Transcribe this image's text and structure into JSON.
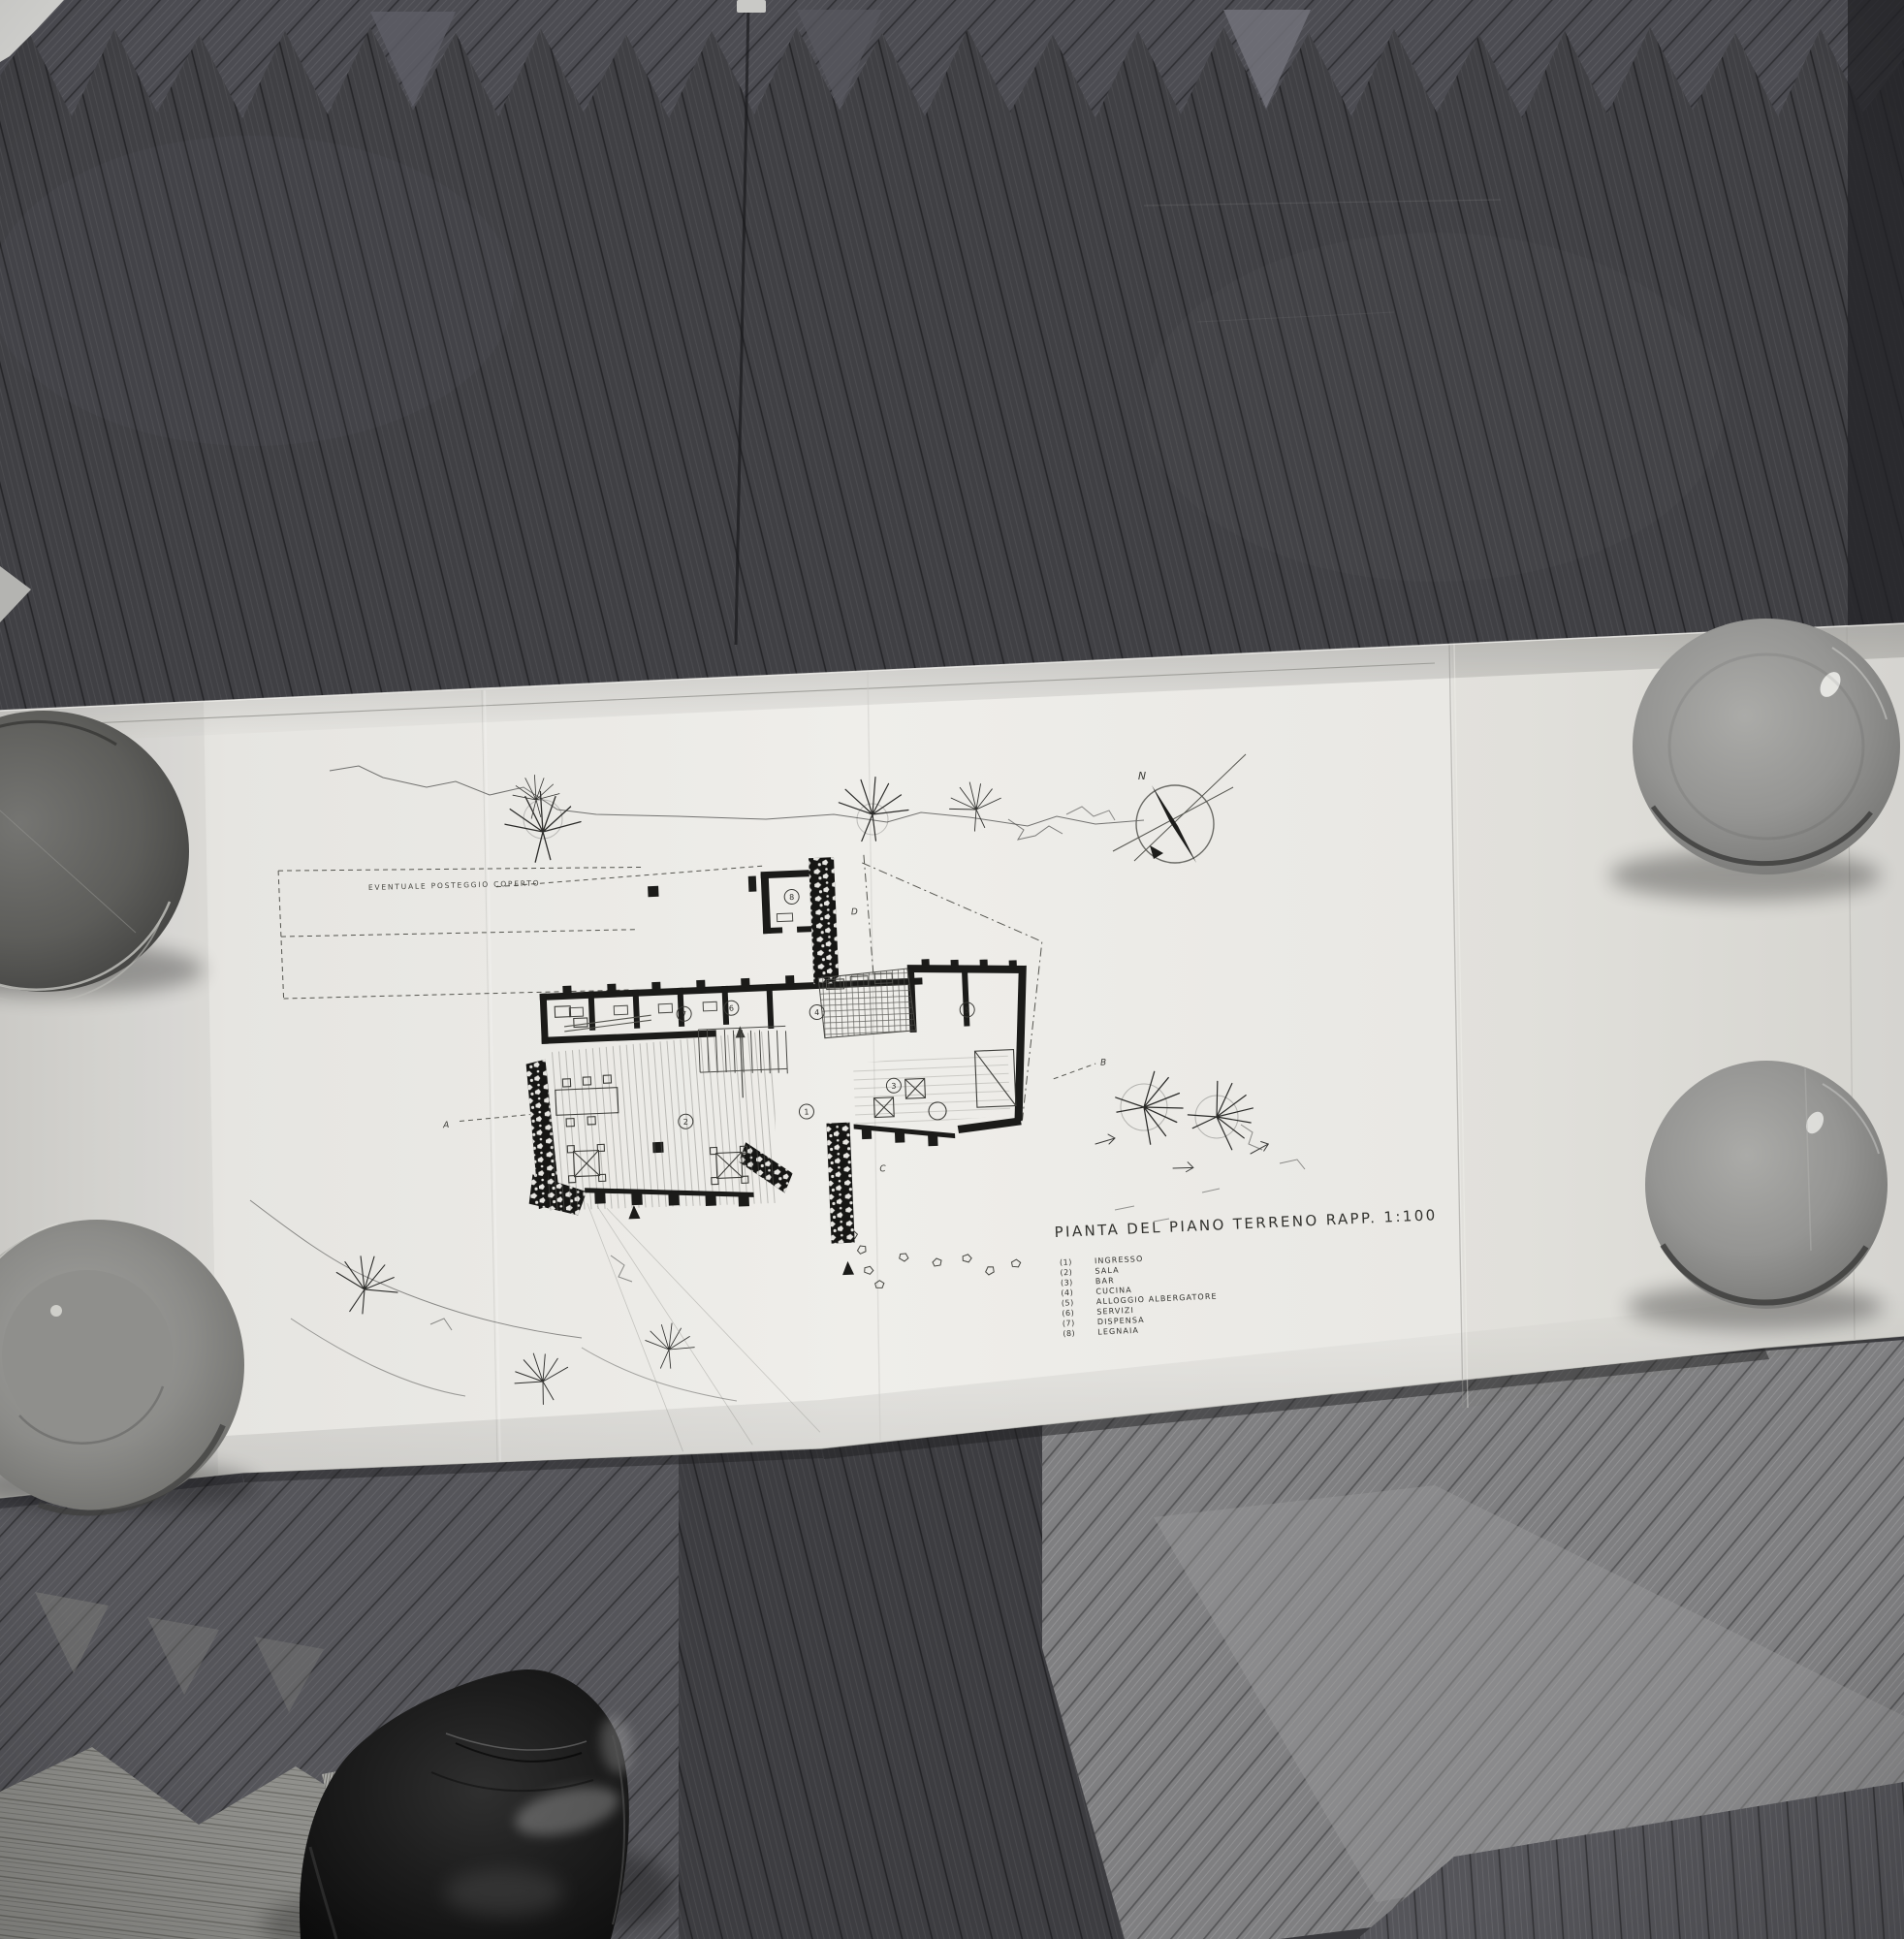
{
  "drawing": {
    "title": "PIANTA DEL PIANO TERRENO  RAPP. 1:100",
    "site_note": "EVENTUALE  POSTEGGIO  COPERTO",
    "compass_label": "N",
    "section_markers": [
      "A",
      "B",
      "C",
      "D"
    ],
    "room_numbers": [
      "1",
      "2",
      "3",
      "4",
      "5",
      "6",
      "7",
      "8"
    ],
    "legend": [
      {
        "num": "(1)",
        "label": "INGRESSO"
      },
      {
        "num": "(2)",
        "label": "SALA"
      },
      {
        "num": "(3)",
        "label": "BAR"
      },
      {
        "num": "(4)",
        "label": "CUCINA"
      },
      {
        "num": "(5)",
        "label": "ALLOGGIO ALBERGATORE"
      },
      {
        "num": "(6)",
        "label": "SERVIZI"
      },
      {
        "num": "(7)",
        "label": "DISPENSA"
      },
      {
        "num": "(8)",
        "label": "LEGNAIA"
      }
    ]
  },
  "palette": {
    "paper": "#efeeea",
    "floor_dark": "#404044",
    "floor_mid": "#55555a",
    "floor_light": "#7f7f81",
    "ink": "#2a2a28",
    "bowl_gray": "#949492",
    "shoe_black": "#141414"
  }
}
